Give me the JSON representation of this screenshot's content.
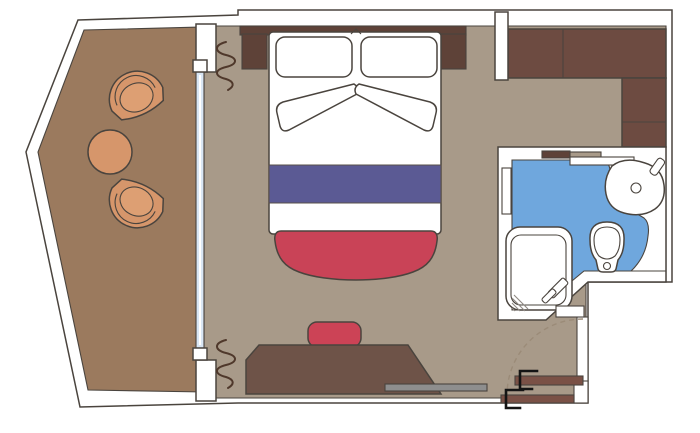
{
  "plan": {
    "type": "cruise-cabin-floor-plan",
    "rooms": {
      "balcony": "balcony-terrace",
      "bedroom": "main-cabin",
      "bathroom": "bathroom",
      "entrance": "entrance-corridor"
    },
    "items": {
      "balcony": [
        "tub-chair",
        "tub-chair",
        "round-coffee-table",
        "glass-door-window",
        "curtains"
      ],
      "bedroom": [
        "double-bed",
        "pillows",
        "bed-runner",
        "foot-bench",
        "nightstands",
        "headboard",
        "desk",
        "stool",
        "tv-shelf",
        "wardrobe"
      ],
      "bathroom": [
        "shower",
        "toilet",
        "washbasin",
        "sliding-door"
      ],
      "entrance": [
        "entrance-door",
        "sliding-door-panels",
        "door-swing-arc"
      ]
    }
  },
  "colors": {
    "outline": "#4a443e",
    "wall": "#ffffff",
    "balcony_floor": "#9b7a5e",
    "room_floor": "#a89a89",
    "wood_dark": "#6d4b41",
    "wood_medium": "#5e4238",
    "door_brown": "#7a5146",
    "desk": "#6e5348",
    "bed_runner": "#5b5a94",
    "bench_red": "#c94357",
    "stool_red": "#cc4356",
    "chair_tan": "#d6966b",
    "chair_seat": "#dd9f73",
    "bath_blue": "#6fa7dd",
    "glass_blue": "#d9e6f4",
    "gray_bar": "#8e8e8e"
  }
}
